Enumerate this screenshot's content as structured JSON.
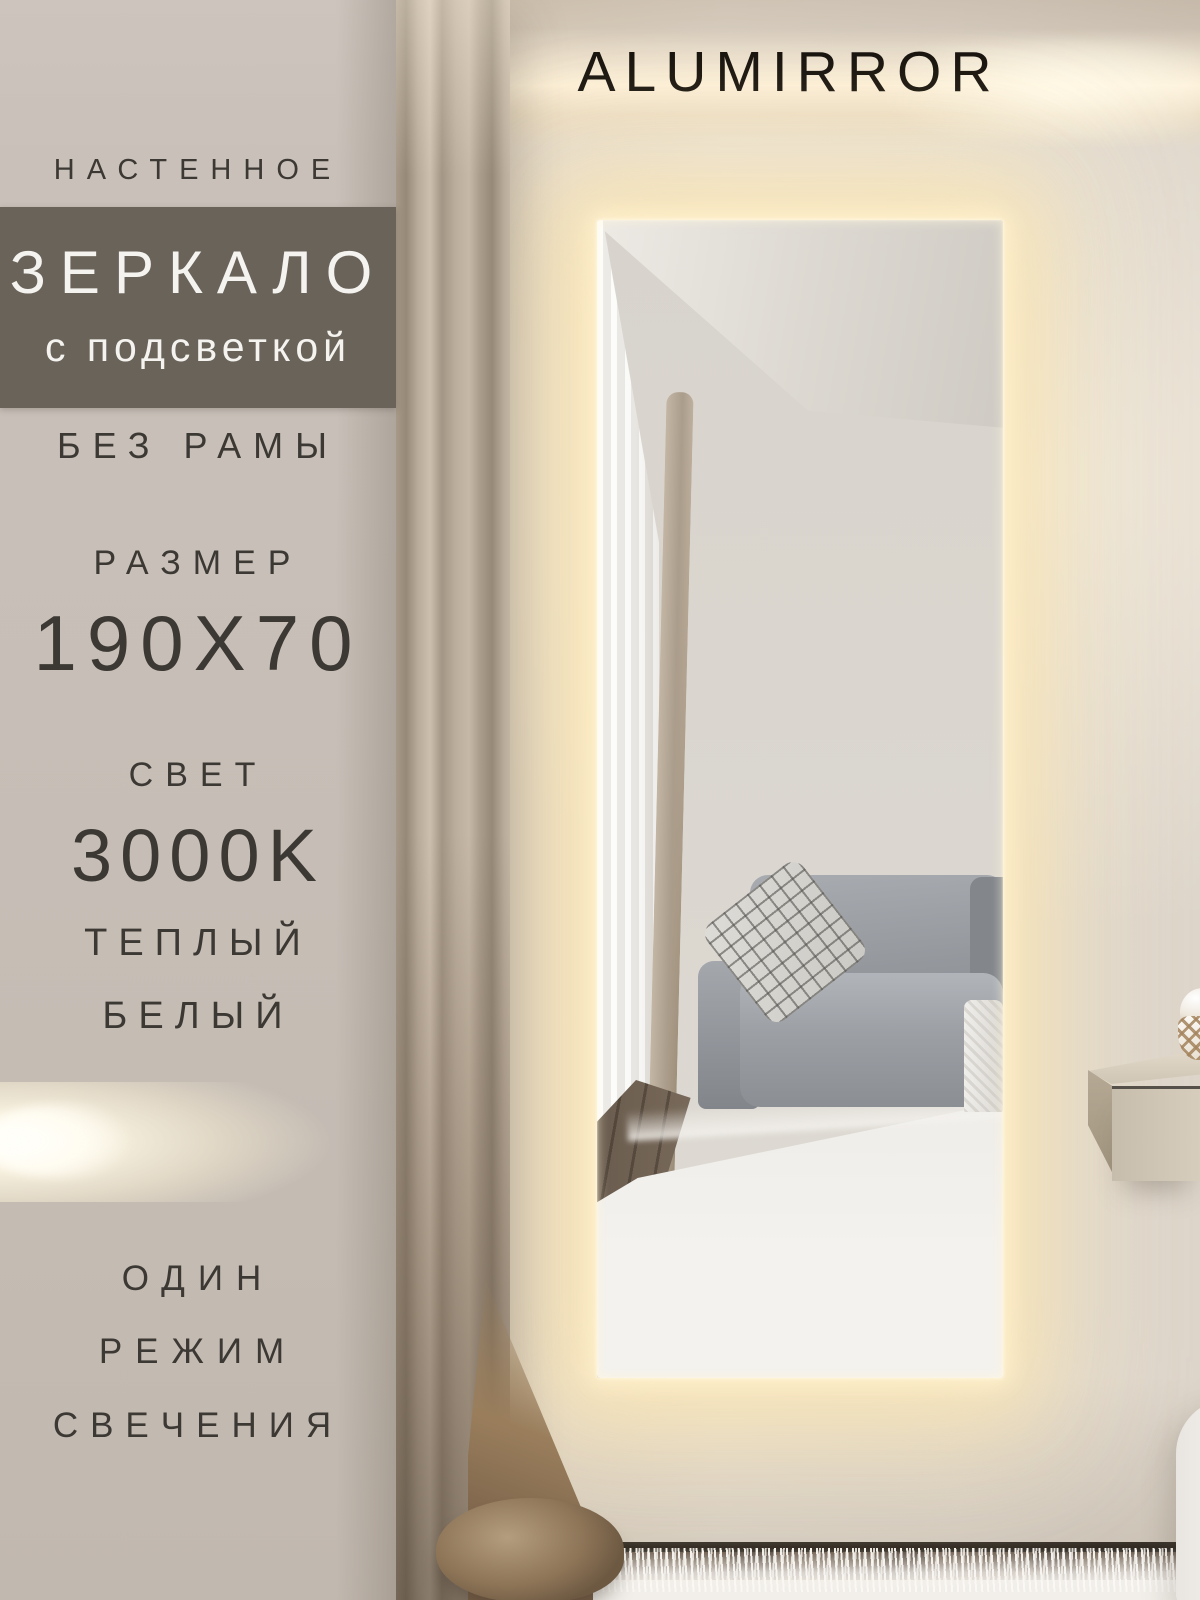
{
  "brand": "ALUMIRROR",
  "left_panel": {
    "kicker": "НАСТЕННОЕ",
    "banner_title": "ЗЕРКАЛО",
    "banner_subtitle": "с подсветкой",
    "frameless": "БЕЗ РАМЫ",
    "size_label": "РАЗМЕР",
    "size_value": "190X70",
    "light_label": "СВЕТ",
    "light_value": "3000K",
    "tone_lines": [
      "ТЕПЛЫЙ",
      "БЕЛЫЙ"
    ],
    "mode_lines": [
      "ОДИН",
      "РЕЖИМ",
      "СВЕЧЕНИЯ"
    ]
  },
  "colors": {
    "banner_bg": "#6a635a",
    "panel_bg": "#c6beb5",
    "panel_text": "#3c3833",
    "banner_text": "#f5f3ef",
    "brand_text": "#16120d",
    "led_glow": "#ffeec2",
    "wall": "#e6dfd5",
    "curtain": "#b3a593",
    "armchair": "#989ca1",
    "wood_floor": "#52463a",
    "rug": "#f2efea"
  }
}
